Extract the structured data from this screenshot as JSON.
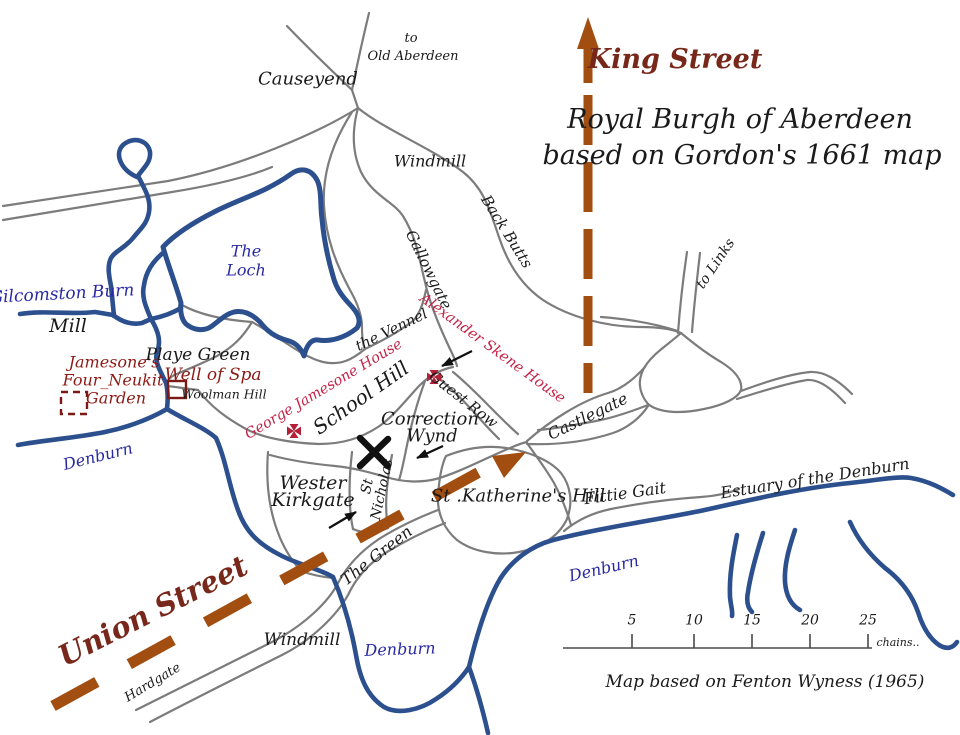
{
  "title": {
    "line1": "Royal Burgh of Aberdeen",
    "line2": "based on Gordon's 1661 map"
  },
  "labels": {
    "king_street": "King Street",
    "union_street": "Union Street",
    "causeyend": "Causeyend",
    "to_old_aberdeen_1": "to",
    "to_old_aberdeen_2": "Old Aberdeen",
    "windmill_top": "Windmill",
    "back_butts": "Back Butts",
    "gallowgate": "Gallowgate",
    "to_links": "to Links",
    "the_loch_1": "The",
    "the_loch_2": "Loch",
    "gilcomston_burn": "Gilcomston Burn",
    "mill": "Mill",
    "jamesone_1": "Jamesone's",
    "jamesone_2": "Four_Neukit",
    "jamesone_3": "Garden",
    "playe_green": "Playe Green",
    "well_of_spa": "Well of Spa",
    "woolman_hill": "Woolman Hill",
    "the_vennel": "the Vennel",
    "george_jamesone_house": "George Jamesone House",
    "alexander_skene_house": "Alexander Skene House",
    "school_hill": "School Hill",
    "guest_row": "Guest Row",
    "correction_wynd_1": "Correction",
    "correction_wynd_2": "Wynd",
    "wester_kirkgate_1": "Wester",
    "wester_kirkgate_2": "Kirkgate",
    "st_nicholas_1": "St",
    "st_nicholas_2": "Nicholas",
    "the_green": "The Green",
    "st_katherines_hill": "St .Katherine's Hill",
    "castlegate": "Castlegate",
    "fittie_gait": "Fittie Gait",
    "estuary_of_the_denburn": "Estuary of the Denburn",
    "denburn_left": "Denburn",
    "denburn_mid": "Denburn",
    "denburn_right": "Denburn",
    "windmill_bottom": "Windmill",
    "hardgate": "Hardgate"
  },
  "scale_bar": {
    "ticks": [
      "5",
      "10",
      "15",
      "20",
      "25"
    ],
    "unit": "chains..",
    "attribution": "Map based on Fenton Wyness (1965)"
  },
  "colors": {
    "road": "#7c7c7c",
    "water": "#2c4f8e",
    "route_dash": "#a14e10",
    "street_text": "#78281a",
    "water_text": "#2929a3",
    "site_text": "#8c1a15",
    "house_text": "#c32347",
    "ink": "#1a1a1a"
  }
}
